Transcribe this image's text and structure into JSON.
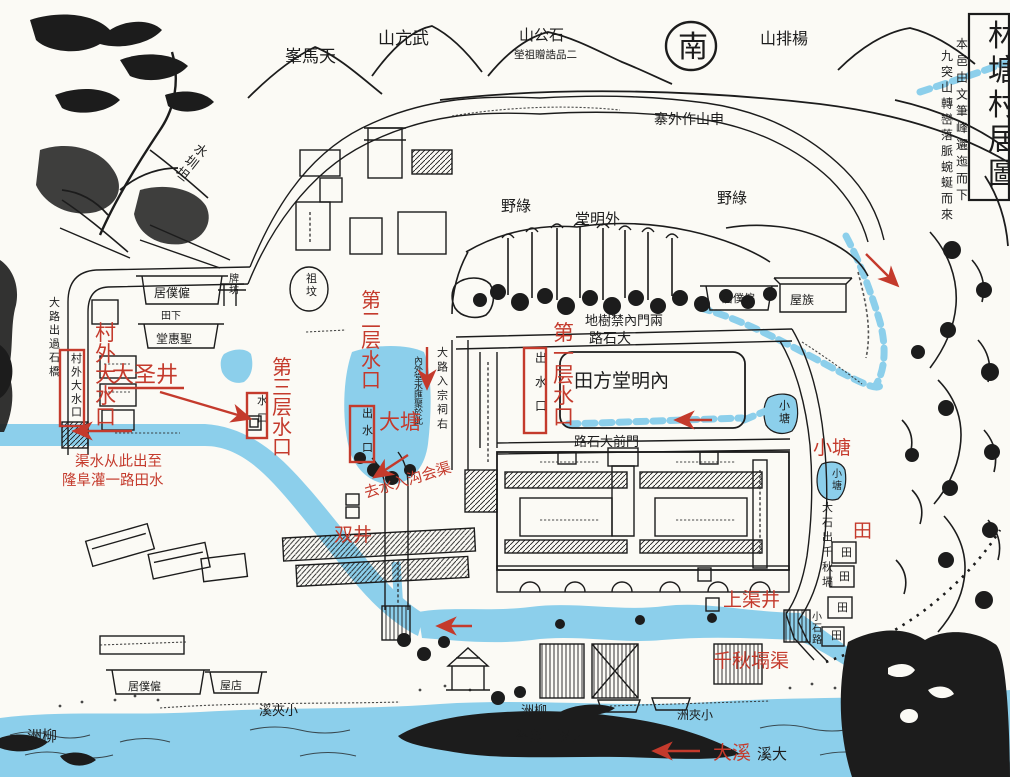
{
  "map": {
    "title": "林塘村居圖",
    "colors": {
      "paper": "#fbfaf5",
      "ink": "#1c1c1c",
      "water": "#8ccfeb",
      "annotation_red": "#c43a2c"
    },
    "black_labels": [
      {
        "name": "map-title",
        "text": "林塘村居圖",
        "x": 988,
        "y": 46,
        "size": 30,
        "orient": "v",
        "gap": 1.15
      },
      {
        "name": "title-note-1",
        "text": "本邑由文筆峰邐迤而下",
        "x": 956,
        "y": 48,
        "size": 12,
        "orient": "v",
        "gap": 1.4
      },
      {
        "name": "title-note-2",
        "text": "九突山轉巒落脈蜿蜒而來",
        "x": 941,
        "y": 60,
        "size": 12,
        "orient": "v",
        "gap": 1.32
      },
      {
        "name": "tianma-peak",
        "text": "天馬峯",
        "x": 285,
        "y": 62,
        "size": 17,
        "orient": "h-rtl"
      },
      {
        "name": "wukang-mountain",
        "text": "武亢山",
        "x": 378,
        "y": 44,
        "size": 17,
        "orient": "h-rtl"
      },
      {
        "name": "shigong-mountain",
        "text": "石公山",
        "x": 519,
        "y": 40,
        "size": 15,
        "orient": "h-rtl"
      },
      {
        "name": "shigong-tomb-note",
        "text": "二品誥贈祖塋",
        "x": 514,
        "y": 58,
        "size": 10.5,
        "orient": "h-rtl"
      },
      {
        "name": "south-char",
        "text": "南",
        "x": 678,
        "y": 57,
        "size": 30,
        "orient": "h"
      },
      {
        "name": "yangpai-mountain",
        "text": "楊排山",
        "x": 760,
        "y": 44,
        "size": 16,
        "orient": "h-rtl"
      },
      {
        "name": "outer-stockade",
        "text": "申山作外寨",
        "x": 654,
        "y": 124,
        "size": 14,
        "orient": "h-rtl"
      },
      {
        "name": "shuizhentan",
        "text": "水圳坦",
        "x": 193,
        "y": 150,
        "size": 13,
        "orient": "v",
        "gap": 1.15,
        "rotate": 38
      },
      {
        "name": "green-field-left",
        "text": "綠野",
        "x": 501,
        "y": 211,
        "size": 15,
        "orient": "h-rtl"
      },
      {
        "name": "green-field-right",
        "text": "綠野",
        "x": 717,
        "y": 203,
        "size": 15,
        "orient": "h-rtl"
      },
      {
        "name": "outer-mingtang",
        "text": "外明堂",
        "x": 575,
        "y": 224,
        "size": 15,
        "orient": "h-rtl"
      },
      {
        "name": "forbidden-tree-ground",
        "text": "兩門內禁樹地",
        "x": 585,
        "y": 325,
        "size": 13,
        "orient": "h-rtl"
      },
      {
        "name": "big-stone-road",
        "text": "大石路",
        "x": 589,
        "y": 343,
        "size": 14,
        "orient": "h-rtl"
      },
      {
        "name": "inner-mingtang-field",
        "text": "內明堂方田",
        "x": 574,
        "y": 387,
        "size": 19,
        "orient": "h-rtl"
      },
      {
        "name": "front-gate-road",
        "text": "門前大石路",
        "x": 574,
        "y": 446,
        "size": 13,
        "orient": "h-rtl"
      },
      {
        "name": "road-to-shrine",
        "text": "大路入宗祠右",
        "x": 437,
        "y": 356,
        "size": 11,
        "orient": "v",
        "gap": 1.3
      },
      {
        "name": "pond-water-note",
        "text": "內外堂水匯聚於此",
        "x": 414,
        "y": 364,
        "size": 9,
        "orient": "v",
        "gap": 0.95
      },
      {
        "name": "stone-road-qianqiu",
        "text": "大石出千秋塥",
        "x": 822,
        "y": 511,
        "size": 11,
        "orient": "v",
        "gap": 1.35
      },
      {
        "name": "small-stone-road",
        "text": "小石路",
        "x": 812,
        "y": 620,
        "size": 10,
        "orient": "v",
        "gap": 1.15
      },
      {
        "name": "small-pond-a",
        "text": "小塘",
        "x": 779,
        "y": 409,
        "size": 11,
        "orient": "v",
        "gap": 1.2
      },
      {
        "name": "small-pond-b",
        "text": "小塘",
        "x": 832,
        "y": 477,
        "size": 10,
        "orient": "v",
        "gap": 1.2
      },
      {
        "name": "clan-house",
        "text": "族屋",
        "x": 790,
        "y": 304,
        "size": 12,
        "orient": "h-rtl"
      },
      {
        "name": "servants-house-left",
        "text": "僱僕居",
        "x": 154,
        "y": 297,
        "size": 12,
        "orient": "h-rtl"
      },
      {
        "name": "servants-house-right",
        "text": "僱僕居",
        "x": 722,
        "y": 302,
        "size": 11,
        "orient": "h-rtl"
      },
      {
        "name": "ancestor-grave",
        "text": "祖坟",
        "x": 306,
        "y": 282,
        "size": 11,
        "orient": "v",
        "gap": 1.2
      },
      {
        "name": "paifang-gate",
        "text": "牌坊",
        "x": 229,
        "y": 282,
        "size": 10,
        "orient": "v",
        "gap": 1.15
      },
      {
        "name": "lower-field",
        "text": "下田",
        "x": 161,
        "y": 319,
        "size": 10,
        "orient": "h-rtl"
      },
      {
        "name": "shenghui-hall",
        "text": "聖惠堂",
        "x": 156,
        "y": 343,
        "size": 12,
        "orient": "h-rtl"
      },
      {
        "name": "shop-house",
        "text": "店屋",
        "x": 220,
        "y": 689,
        "size": 11,
        "orient": "h-rtl"
      },
      {
        "name": "servants-house-bottom",
        "text": "僱僕居",
        "x": 128,
        "y": 690,
        "size": 11,
        "orient": "h-rtl"
      },
      {
        "name": "small-gorge-creek",
        "text": "小夾溪",
        "x": 259,
        "y": 715,
        "size": 13,
        "orient": "h-rtl"
      },
      {
        "name": "willow-isle-mid",
        "text": "柳洲",
        "x": 521,
        "y": 715,
        "size": 13,
        "orient": "h-rtl"
      },
      {
        "name": "small-gorge-isle",
        "text": "小夾洲",
        "x": 677,
        "y": 719,
        "size": 12,
        "orient": "h-rtl"
      },
      {
        "name": "fish-rock-note",
        "text": "大溪中魚碆",
        "x": 515,
        "y": 741,
        "size": 14,
        "orient": "h-rtl"
      },
      {
        "name": "big-creek-black",
        "text": "大溪",
        "x": 757,
        "y": 759,
        "size": 15,
        "orient": "h-rtl"
      },
      {
        "name": "willow-isle-left",
        "text": "柳洲",
        "x": 27,
        "y": 741,
        "size": 15,
        "orient": "h-rtl"
      },
      {
        "name": "road-stone-bridge",
        "text": "大路出過石橋",
        "x": 49,
        "y": 306,
        "size": 11,
        "orient": "v",
        "gap": 1.25
      },
      {
        "name": "village-outlet-black",
        "text": "村外大水口",
        "x": 71,
        "y": 362,
        "size": 11,
        "orient": "v",
        "gap": 1.22
      },
      {
        "name": "outlet-text-1",
        "text": "出水口",
        "x": 535,
        "y": 362,
        "size": 12,
        "orient": "v",
        "gap": 2.0
      },
      {
        "name": "outlet-text-2",
        "text": "出水口",
        "x": 362,
        "y": 417,
        "size": 11,
        "orient": "v",
        "gap": 1.55
      },
      {
        "name": "outlet-text-3",
        "text": "水口",
        "x": 257,
        "y": 404,
        "size": 11,
        "orient": "v",
        "gap": 1.6
      },
      {
        "name": "field-char-1",
        "text": "田",
        "x": 841,
        "y": 556,
        "size": 11,
        "orient": "h"
      },
      {
        "name": "field-char-2",
        "text": "田",
        "x": 839,
        "y": 580,
        "size": 11,
        "orient": "h"
      },
      {
        "name": "field-char-3",
        "text": "田",
        "x": 837,
        "y": 611,
        "size": 11,
        "orient": "h"
      },
      {
        "name": "field-char-4",
        "text": "田",
        "x": 831,
        "y": 639,
        "size": 11,
        "orient": "h"
      }
    ],
    "red_annotations": {
      "labels": [
        {
          "name": "anno-village-outer-outlet",
          "text": "村外大水口",
          "x": 95,
          "y": 340,
          "size": 21,
          "orient": "v",
          "gap": 1.0
        },
        {
          "name": "anno-dasheng-well",
          "text": "大圣井",
          "x": 112,
          "y": 382,
          "size": 22,
          "orient": "h"
        },
        {
          "name": "anno-third-layer-outlet",
          "text": "第三层水口",
          "x": 272,
          "y": 374,
          "size": 20,
          "orient": "v",
          "gap": 1.0
        },
        {
          "name": "anno-second-layer-outlet",
          "text": "第二层水口",
          "x": 361,
          "y": 307,
          "size": 20,
          "orient": "v",
          "gap": 1.0
        },
        {
          "name": "anno-big-pond",
          "text": "大塘",
          "x": 379,
          "y": 429,
          "size": 21,
          "orient": "h"
        },
        {
          "name": "anno-drain-note",
          "text": "去水入沟会渠",
          "x": 366,
          "y": 498,
          "size": 15,
          "orient": "h",
          "rotate": -17
        },
        {
          "name": "anno-first-layer-outlet",
          "text": "第一层水口",
          "x": 553,
          "y": 340,
          "size": 21,
          "orient": "v",
          "gap": 1.0
        },
        {
          "name": "anno-small-pond",
          "text": "小塘",
          "x": 813,
          "y": 454,
          "size": 19,
          "orient": "h"
        },
        {
          "name": "anno-field",
          "text": "田",
          "x": 853,
          "y": 537,
          "size": 19,
          "orient": "h"
        },
        {
          "name": "anno-upper-channel-well",
          "text": "上渠井",
          "x": 723,
          "y": 606,
          "size": 19,
          "orient": "h"
        },
        {
          "name": "anno-qianqiu-channel",
          "text": "千秋塥渠",
          "x": 713,
          "y": 667,
          "size": 19,
          "orient": "h"
        },
        {
          "name": "anno-big-creek",
          "text": "大溪",
          "x": 713,
          "y": 759,
          "size": 19,
          "orient": "h"
        },
        {
          "name": "anno-double-well",
          "text": "双井",
          "x": 334,
          "y": 541,
          "size": 19,
          "orient": "h"
        },
        {
          "name": "anno-note-line-1",
          "text": "渠水从此出至",
          "x": 75,
          "y": 466,
          "size": 14.5,
          "orient": "h"
        },
        {
          "name": "anno-note-line-2",
          "text": "隆阜灌一路田水",
          "x": 62,
          "y": 485,
          "size": 14.5,
          "orient": "h"
        }
      ]
    }
  }
}
